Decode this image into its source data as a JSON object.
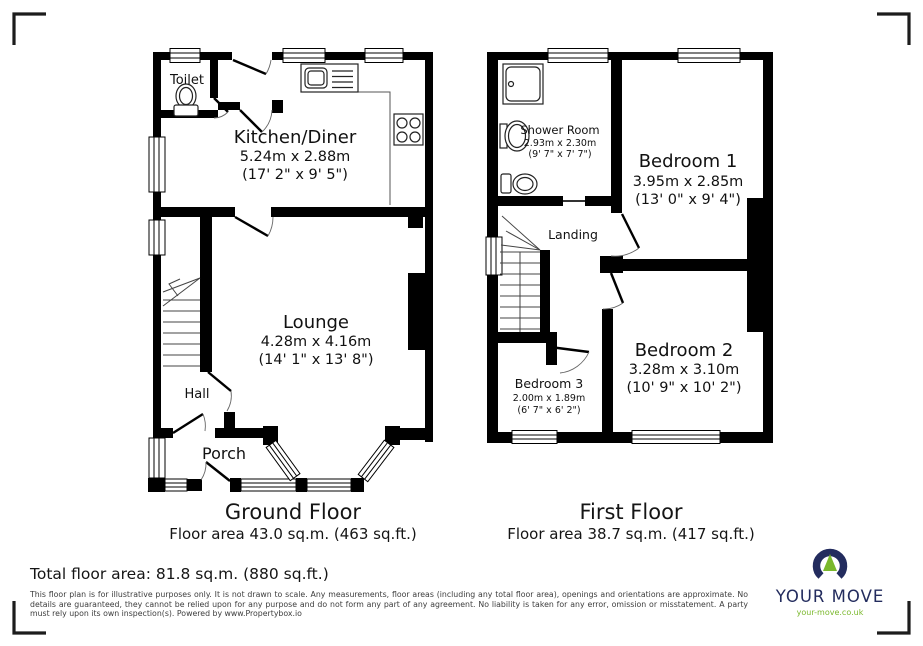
{
  "floors": [
    {
      "title": "Ground Floor",
      "area": "Floor area 43.0 sq.m. (463 sq.ft.)"
    },
    {
      "title": "First Floor",
      "area": "Floor area 38.7 sq.m. (417 sq.ft.)"
    }
  ],
  "rooms": {
    "toilet": {
      "name": "Toilet"
    },
    "kitchen": {
      "name": "Kitchen/Diner",
      "metric": "5.24m x 2.88m",
      "imperial": "(17' 2\" x 9' 5\")"
    },
    "lounge": {
      "name": "Lounge",
      "metric": "4.28m x 4.16m",
      "imperial": "(14' 1\" x 13' 8\")"
    },
    "hall": {
      "name": "Hall"
    },
    "porch": {
      "name": "Porch"
    },
    "shower": {
      "name": "Shower Room",
      "metric": "2.93m x 2.30m",
      "imperial": "(9' 7\" x 7' 7\")"
    },
    "bedroom1": {
      "name": "Bedroom 1",
      "metric": "3.95m x 2.85m",
      "imperial": "(13' 0\" x 9' 4\")"
    },
    "bedroom2": {
      "name": "Bedroom 2",
      "metric": "3.28m x 3.10m",
      "imperial": "(10' 9\" x 10' 2\")"
    },
    "bedroom3": {
      "name": "Bedroom 3",
      "metric": "2.00m x 1.89m",
      "imperial": "(6' 7\" x 6' 2\")"
    },
    "landing": {
      "name": "Landing"
    }
  },
  "total": "Total floor area: 81.8 sq.m. (880 sq.ft.)",
  "disclaimer": "This floor plan is for illustrative purposes only. It is not drawn to scale. Any measurements, floor areas (including any total floor area), openings and orientations are approximate. No details are guaranteed, they cannot be relied upon for any purpose and do not form any part of any agreement. No liability is taken for any error, omission or misstatement. A party must rely upon its own inspection(s). Powered by www.Propertybox.io",
  "logo": {
    "brand": "YOUR MOVE",
    "url": "your-move.co.uk",
    "navy": "#232c5e",
    "green": "#7ab82c"
  },
  "icons": {
    "toilet": "toilet-icon",
    "sink": "sink-drainer-icon",
    "hob": "hob-icon",
    "shower": "shower-tray-icon",
    "basin": "basin-icon",
    "stairs": "stairs-symbol",
    "logo_mark": "horseshoe-logo-icon"
  }
}
